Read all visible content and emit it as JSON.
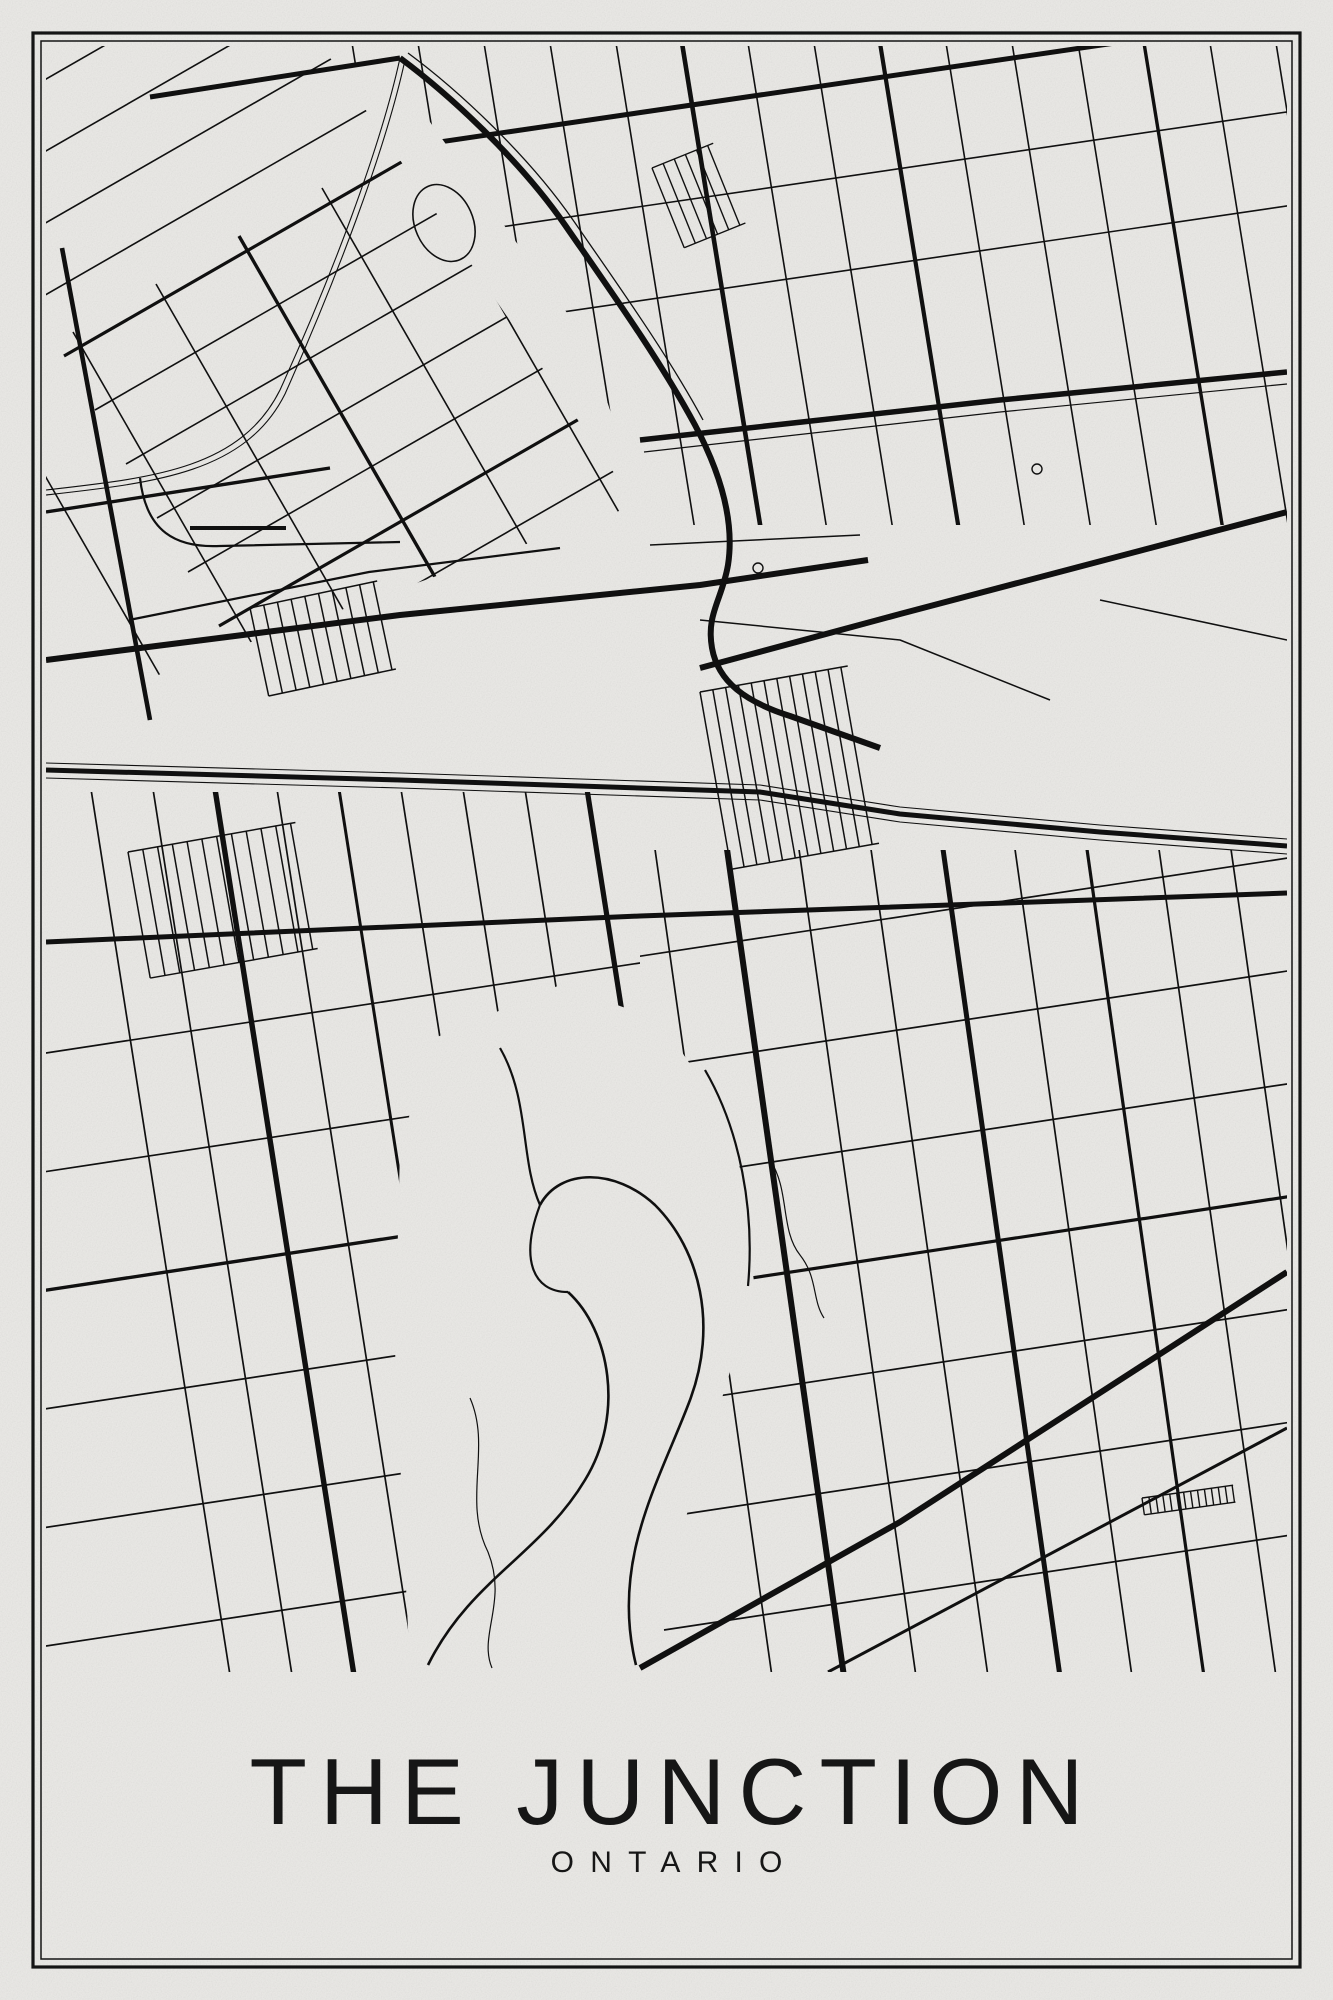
{
  "poster": {
    "title": "THE JUNCTION",
    "subtitle": "ONTARIO",
    "colors": {
      "paper": "#ebeae7",
      "ink": "#101010",
      "text": "#161616",
      "frame": "#151515"
    }
  },
  "map": {
    "clips": {
      "map": [
        [
          46,
          46
        ],
        [
          1287,
          46
        ],
        [
          1287,
          1672
        ],
        [
          46,
          1672
        ]
      ],
      "ztl": [
        [
          46,
          46
        ],
        [
          322,
          46
        ],
        [
          636,
          505
        ],
        [
          46,
          715
        ]
      ],
      "ztr": [
        [
          330,
          46
        ],
        [
          1287,
          46
        ],
        [
          1287,
          525
        ],
        [
          650,
          525
        ],
        [
          585,
          338
        ],
        [
          430,
          122
        ]
      ],
      "zbl": [
        [
          46,
          792
        ],
        [
          640,
          792
        ],
        [
          640,
          1672
        ],
        [
          46,
          1672
        ]
      ],
      "zbr": [
        [
          640,
          850
        ],
        [
          1287,
          850
        ],
        [
          1287,
          1672
        ],
        [
          640,
          1672
        ]
      ]
    },
    "layers": [
      {
        "t": "grid",
        "clip": "ztl",
        "p0": [
          -60,
          140
        ],
        "step": [
          31,
          54
        ],
        "n": 16,
        "dir": [
          0.87,
          -0.5
        ],
        "len": 1000,
        "w": 1.6,
        "thick": {
          "4": 3.2,
          "9": 3.2,
          "13": 3.2
        }
      },
      {
        "t": "grid",
        "clip": "ztl",
        "p0": [
          -10,
          380
        ],
        "step": [
          83,
          -48
        ],
        "n": 10,
        "dir": [
          0.5,
          0.87
        ],
        "len": 820,
        "w": 1.6,
        "thick": {
          "3": 3.4,
          "7": 3.4
        }
      },
      {
        "t": "grid",
        "clip": "ztr",
        "p0": [
          346,
          6
        ],
        "step": [
          66,
          0
        ],
        "n": 15,
        "dir": [
          0.16,
          0.987
        ],
        "len": 590,
        "w": 1.6,
        "thick": {
          "5": 4.6,
          "8": 4.2,
          "12": 3.4
        }
      },
      {
        "t": "grid",
        "clip": "ztr",
        "p0": [
          330,
          158
        ],
        "step": [
          14,
          92
        ],
        "n": 3,
        "dir": [
          0.99,
          -0.145
        ],
        "len": 1000,
        "w": 1.6,
        "thick": {
          "0": 5
        }
      },
      {
        "t": "grid",
        "clip": "zbl",
        "p0": [
          88,
          770
        ],
        "step": [
          62,
          0
        ],
        "n": 9,
        "dir": [
          0.155,
          0.988
        ],
        "len": 960,
        "w": 1.7,
        "thick": {
          "2": 5.4,
          "4": 3,
          "8": 5.2
        }
      },
      {
        "t": "grid",
        "clip": "zbl",
        "p0": [
          26,
          1056
        ],
        "step": [
          4,
          118
        ],
        "n": 6,
        "dir": [
          0.99,
          -0.15
        ],
        "len": 660,
        "w": 1.7,
        "thick": {
          "2": 3.4
        }
      },
      {
        "t": "grid",
        "clip": "zbr",
        "p0": [
          652,
          828
        ],
        "step": [
          72,
          0
        ],
        "n": 9,
        "dir": [
          0.14,
          0.99
        ],
        "len": 910,
        "w": 1.7,
        "thick": {
          "1": 6,
          "4": 5,
          "6": 3.2
        }
      },
      {
        "t": "grid",
        "clip": "zbr",
        "p0": [
          628,
          958
        ],
        "step": [
          6,
          112
        ],
        "n": 7,
        "dir": [
          0.99,
          -0.15
        ],
        "len": 700,
        "w": 1.7,
        "thick": {
          "3": 3.2
        }
      },
      {
        "t": "poly",
        "fill": "#ebeae7",
        "pts": [
          [
            430,
            1040
          ],
          [
            560,
            985
          ],
          [
            660,
            1020
          ],
          [
            735,
            1130
          ],
          [
            755,
            1290
          ],
          [
            700,
            1470
          ],
          [
            640,
            1672
          ],
          [
            410,
            1672
          ],
          [
            395,
            1350
          ],
          [
            400,
            1150
          ]
        ]
      },
      {
        "t": "hatch",
        "x": 700,
        "y": 692,
        "w": 150,
        "h": 180,
        "rot": -10,
        "sp": 13,
        "lw": 1.5
      },
      {
        "t": "hatch",
        "x": 128,
        "y": 852,
        "w": 170,
        "h": 128,
        "rot": -10,
        "sp": 15,
        "lw": 1.5
      },
      {
        "t": "hatch",
        "x": 250,
        "y": 608,
        "w": 130,
        "h": 90,
        "rot": -12,
        "sp": 14,
        "lw": 1.5
      },
      {
        "t": "hatch",
        "x": 652,
        "y": 168,
        "w": 66,
        "h": 86,
        "rot": -22,
        "sp": 12,
        "lw": 1.4
      },
      {
        "t": "hatch",
        "x": 1142,
        "y": 1498,
        "w": 92,
        "h": 17,
        "rot": -8,
        "sp": 7,
        "lw": 1.4
      },
      {
        "t": "ellipse",
        "cx": 444,
        "cy": 223,
        "rx": 29,
        "ry": 40,
        "rot": -24,
        "w": 1.6
      },
      {
        "t": "path",
        "d": "M400,58 C380,150 330,280 280,390 C240,470 150,478 46,490",
        "w": 1.1
      },
      {
        "t": "path",
        "d": "M405,60 C385,152 335,282 285,394 C245,474 152,483 46,495",
        "w": 1.1
      },
      {
        "t": "path",
        "d": "M140,478 C146,532 176,548 220,546 L400,542",
        "w": 2.2
      },
      {
        "t": "poly",
        "pts": [
          [
            190,
            528
          ],
          [
            286,
            528
          ]
        ],
        "w": 4
      },
      {
        "t": "poly",
        "pts": [
          [
            129,
            620
          ],
          [
            369,
            572
          ],
          [
            560,
            548
          ]
        ],
        "w": 2.2
      },
      {
        "t": "path",
        "d": "M470,1398 C492,1448 462,1500 488,1552 C508,1602 478,1635 492,1668",
        "w": 1.2
      },
      {
        "t": "path",
        "d": "M770,1160 C790,1190 780,1230 800,1255 C818,1278 812,1300 824,1318",
        "w": 1.2
      },
      {
        "t": "path",
        "d": "M636,1665 C610,1560 660,1480 690,1400 C718,1325 700,1250 655,1205 C615,1168 560,1168 540,1205",
        "w": 2.6
      },
      {
        "t": "path",
        "d": "M428,1665 C470,1580 540,1555 585,1480 C625,1415 610,1330 568,1292",
        "w": 2.6
      },
      {
        "t": "path",
        "d": "M540,1205 C520,1258 532,1292 568,1292",
        "w": 2.2
      },
      {
        "t": "path",
        "d": "M705,1070 C740,1130 755,1210 748,1286",
        "w": 2.2
      },
      {
        "t": "path",
        "d": "M500,1048 C530,1100 520,1160 540,1205",
        "w": 2.2
      },
      {
        "t": "poly",
        "pts": [
          [
            150,
            97
          ],
          [
            400,
            58
          ]
        ],
        "w": 5
      },
      {
        "t": "path",
        "d": "M400,58 C450,95 520,160 565,225 C610,290 660,360 695,425 C720,472 735,520 728,565 C722,600 706,614 712,648 C718,682 746,702 790,716 L880,748",
        "w": 6
      },
      {
        "t": "path",
        "d": "M408,53 C458,90 528,155 573,220 C618,285 668,355 703,420",
        "w": 1.3
      },
      {
        "t": "poly",
        "pts": [
          [
            640,
            440
          ],
          [
            1000,
            400
          ],
          [
            1287,
            372
          ]
        ],
        "w": 5.5
      },
      {
        "t": "poly",
        "pts": [
          [
            644,
            452
          ],
          [
            1000,
            412
          ],
          [
            1287,
            384
          ]
        ],
        "w": 1.2
      },
      {
        "t": "poly",
        "pts": [
          [
            46,
            512
          ],
          [
            330,
            468
          ]
        ],
        "w": 3.4
      },
      {
        "t": "poly",
        "pts": [
          [
            62,
            248
          ],
          [
            150,
            720
          ]
        ],
        "w": 4.6
      },
      {
        "t": "poly",
        "pts": [
          [
            46,
            660
          ],
          [
            400,
            615
          ],
          [
            700,
            585
          ],
          [
            868,
            560
          ]
        ],
        "w": 6
      },
      {
        "t": "poly",
        "pts": [
          [
            700,
            668
          ],
          [
            900,
            614
          ],
          [
            1287,
            512
          ]
        ],
        "w": 6
      },
      {
        "t": "poly",
        "pts": [
          [
            46,
            770
          ],
          [
            400,
            780
          ],
          [
            760,
            792
          ],
          [
            900,
            814
          ],
          [
            1100,
            832
          ],
          [
            1287,
            846
          ]
        ],
        "w": 5
      },
      {
        "t": "poly",
        "pts": [
          [
            46,
            763
          ],
          [
            400,
            773
          ],
          [
            760,
            785
          ],
          [
            900,
            807
          ],
          [
            1100,
            825
          ],
          [
            1287,
            839
          ]
        ],
        "w": 1.1
      },
      {
        "t": "poly",
        "pts": [
          [
            46,
            778
          ],
          [
            400,
            788
          ],
          [
            760,
            800
          ],
          [
            900,
            822
          ],
          [
            1100,
            840
          ],
          [
            1287,
            854
          ]
        ],
        "w": 1.1
      },
      {
        "t": "poly",
        "pts": [
          [
            46,
            942
          ],
          [
            640,
            916
          ],
          [
            1287,
            893
          ]
        ],
        "w": 5
      },
      {
        "t": "poly",
        "pts": [
          [
            640,
            1668
          ],
          [
            900,
            1522
          ],
          [
            1287,
            1272
          ]
        ],
        "w": 6
      },
      {
        "t": "poly",
        "pts": [
          [
            828,
            1672
          ],
          [
            1287,
            1428
          ]
        ],
        "w": 3
      },
      {
        "t": "poly",
        "pts": [
          [
            650,
            545
          ],
          [
            860,
            535
          ]
        ],
        "w": 1.5
      },
      {
        "t": "poly",
        "pts": [
          [
            700,
            620
          ],
          [
            900,
            640
          ],
          [
            1050,
            700
          ]
        ],
        "w": 1.5
      },
      {
        "t": "poly",
        "pts": [
          [
            1100,
            600
          ],
          [
            1287,
            640
          ]
        ],
        "w": 1.5
      },
      {
        "t": "circle",
        "cx": 758,
        "cy": 568,
        "r": 5,
        "w": 1.4
      },
      {
        "t": "circle",
        "cx": 1037,
        "cy": 469,
        "r": 5,
        "w": 1.4
      }
    ]
  }
}
